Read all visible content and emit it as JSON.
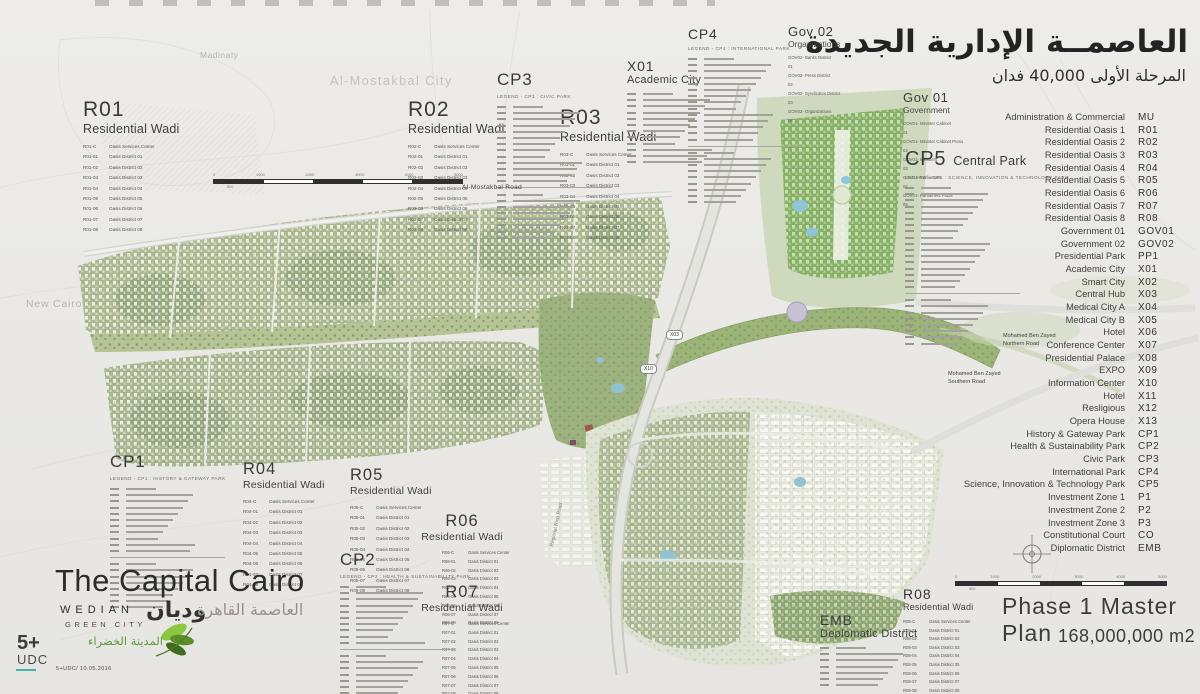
{
  "header": {
    "title_ar": "العاصمــة الإدارية الجديدة",
    "subtitle_ar": "المرحلة الأولى 40,000 فدان"
  },
  "context": {
    "madinaty": "Madinaty",
    "mostakbal_city": "Al-Mostakbal City",
    "new_cairo": "New Cairo"
  },
  "roads": {
    "mostakbal_road": "Al-Mostakbal Road",
    "mbz_north_1": "Mohamed Ben Zayed",
    "mbz_north_2": "Northern Road",
    "mbz_south_1": "Mohamed Ben Zayed",
    "mbz_south_2": "Southern Road",
    "ring_road": "Regional Ring Road"
  },
  "markers": {
    "x03": "X03",
    "x10": "X10"
  },
  "legend": {
    "rows": [
      [
        "Administration & Commercial",
        "MU"
      ],
      [
        "Residential Oasis 1",
        "R01"
      ],
      [
        "Residential Oasis 2",
        "R02"
      ],
      [
        "Residential Oasis 3",
        "R03"
      ],
      [
        "Residential Oasis 4",
        "R04"
      ],
      [
        "Residential Oasis 5",
        "R05"
      ],
      [
        "Residential Oasis 6",
        "R06"
      ],
      [
        "Residential Oasis 7",
        "R07"
      ],
      [
        "Residential Oasis 8",
        "R08"
      ],
      [
        "Government 01",
        "GOV01"
      ],
      [
        "Government 02",
        "GOV02"
      ],
      [
        "Presidential Park",
        "PP1"
      ],
      [
        "Academic City",
        "X01"
      ],
      [
        "Smart City",
        "X02"
      ],
      [
        "Central Hub",
        "X03"
      ],
      [
        "Medical City A",
        "X04"
      ],
      [
        "Medical City B",
        "X05"
      ],
      [
        "Hotel",
        "X06"
      ],
      [
        "Conference Center",
        "X07"
      ],
      [
        "Presidential Palace",
        "X08"
      ],
      [
        "EXPO",
        "X09"
      ],
      [
        "Information Center",
        "X10"
      ],
      [
        "Hotel",
        "X11"
      ],
      [
        "Resligious",
        "X12"
      ],
      [
        "Opera House",
        "X13"
      ],
      [
        "History & Gateway Park",
        "CP1"
      ],
      [
        "Health & Sustainability Park",
        "CP2"
      ],
      [
        "Civic Park",
        "CP3"
      ],
      [
        "International Park",
        "CP4"
      ],
      [
        "Science, Innovation & Technology Park",
        "CP5"
      ],
      [
        "Investment Zone 1",
        "P1"
      ],
      [
        "Investment Zone 2",
        "P2"
      ],
      [
        "Investment Zone 3",
        "P3"
      ],
      [
        "Constitutional Court",
        "CO"
      ],
      [
        "Diplomatic District",
        "EMB"
      ]
    ]
  },
  "blocks": {
    "r01": {
      "code": "R01",
      "title": "Residential Wadi",
      "services": "Oasis Services Center",
      "district": "Oasis District",
      "count": 8
    },
    "r02": {
      "code": "R02",
      "title": "Residential Wadi",
      "services": "Oasis Services Center",
      "district": "Oasis District",
      "count": 8
    },
    "r03": {
      "code": "R03",
      "title": "Residential Wadi",
      "services": "Oasis Services Center",
      "district": "Oasis District",
      "count": 8
    },
    "r04": {
      "code": "R04",
      "title": "Residential Wadi",
      "services": "Oasis Services Center",
      "district": "Oasis District",
      "count": 8
    },
    "r05": {
      "code": "R05",
      "title": "Residential Wadi",
      "services": "Oasis Services Center",
      "district": "Oasis District",
      "count": 8
    },
    "r06": {
      "code": "R06",
      "title": "Residential Wadi",
      "services": "Oasis Services Center",
      "district": "Oasis District",
      "count": 8
    },
    "r07": {
      "code": "R07",
      "title": "Residential Wadi",
      "services": "Oasis Services Center",
      "district": "Oasis District",
      "count": 8
    },
    "r08": {
      "code": "R08",
      "title": "Residential Wadi",
      "services": "Oasis Services Center",
      "district": "Oasis District",
      "count": 8
    },
    "cp1": {
      "code": "CP1",
      "subtitle": "LEGEND - CP1 : HISTORY & GATEWAY PARK",
      "rows": 11,
      "rows2": 8
    },
    "cp2": {
      "code": "CP2",
      "subtitle": "LEGEND - CP2 : HEALTH & SUSTAINABILITY PARK",
      "rows": 10,
      "rows2": 8
    },
    "cp3": {
      "code": "CP3",
      "subtitle": "LEGEND - CP3 : CIVIC PARK",
      "rows": 13,
      "rows2": 8
    },
    "cp4": {
      "code": "CP4",
      "subtitle": "LEGEND - CP4 : INTERNATIONAL PARK",
      "rows": 14,
      "rows2": 9
    },
    "cp5": {
      "code": "CP5",
      "title": "Central Park",
      "subtitle": "LEGEND - CP5 : SCIENCE, INNOVATION & TECHNOLOGY PARK",
      "rows": 17,
      "rows2": 8
    },
    "x01": {
      "code": "X01",
      "title": "Academic City",
      "rows": 12
    },
    "gov01": {
      "code": "Gov 01",
      "title": "Government",
      "items": [
        [
          "GOV01-01",
          "Minister Cabinet"
        ],
        [
          "GOV01-02",
          "Minister Cabinet Press"
        ],
        [
          "GOV01-03",
          "Ministers"
        ],
        [
          "GOV01-04",
          "Parliament"
        ],
        [
          "GOV01-05",
          "Parliament Plaza"
        ]
      ]
    },
    "gov02": {
      "code": "Gov 02",
      "title": "Organizations",
      "items": [
        [
          "GOV02-01",
          "Banks District"
        ],
        [
          "GOV02-02",
          "Press District"
        ],
        [
          "GOV02-03",
          "Syndicates District"
        ],
        [
          "GOV02-04",
          "Organizations"
        ]
      ]
    },
    "emb": {
      "code": "EMB",
      "title": "Deplomatic District",
      "rows": 7
    }
  },
  "branding": {
    "title": "The Capital Cairo",
    "title_ar": "العاصمة القاهرة",
    "wedian": "WEDIAN",
    "green_city": "GREEN CITY",
    "wedian_ar": "وديان",
    "wedian_ar_sub": "المدينة الخضراء",
    "udc_top": "5+",
    "udc_bottom": "UDC",
    "credit": "5+UDC/ 10.05.2016"
  },
  "footer": {
    "phase": "Phase 1 Master Plan",
    "area": "168,000,000 m2"
  },
  "scalebar": {
    "labels": [
      "0",
      "1000",
      "2000",
      "3000",
      "4000",
      "5000"
    ],
    "sub": "500"
  }
}
